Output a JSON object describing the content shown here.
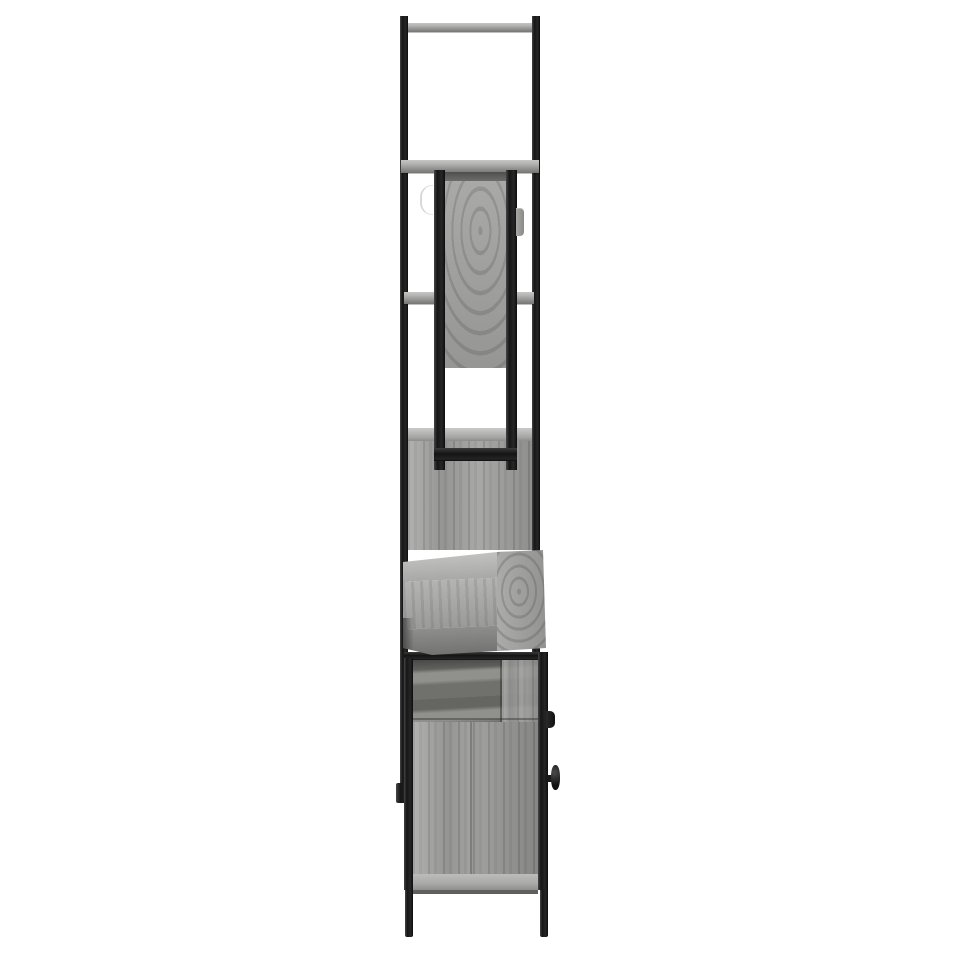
{
  "scene": {
    "type": "product-photo",
    "subject": "bathroom furniture set, side profile view",
    "material_finish": "grey sonoma oak with black powder-coated steel frame",
    "background": "plain white studio background",
    "parts": {
      "tall_frame": "two vertical black steel posts with top shelf",
      "shelf_top": "narrow grey wood shelf at top of frame",
      "shelf_mid": "grey wood shelf above mirror cabinet",
      "shelf_low": "grey wood shelf behind mirror cabinet",
      "mirror_cabinet": "wall mirror cabinet seen edge-on with black frame rails",
      "mirror_handle": "small grey door tab handle",
      "towel_hook": "thin light hook on left side of mirror cabinet",
      "storage_block": "tall grey wood storage section",
      "vanity_top": "grey wood table top protruding to the right",
      "base_cabinet": "black-framed base cabinet with grey wood panels",
      "door_knobs": "two black door knobs on right face of base cabinet",
      "legs": "two black steel legs"
    }
  },
  "palette": {
    "bg": "#ffffff",
    "metal": "#1a1a1a",
    "wood-light": "#b2b2b0",
    "wood-base": "#9e9e9c",
    "wood-dark": "#84847f",
    "edge-light": "#d9d9d7"
  }
}
